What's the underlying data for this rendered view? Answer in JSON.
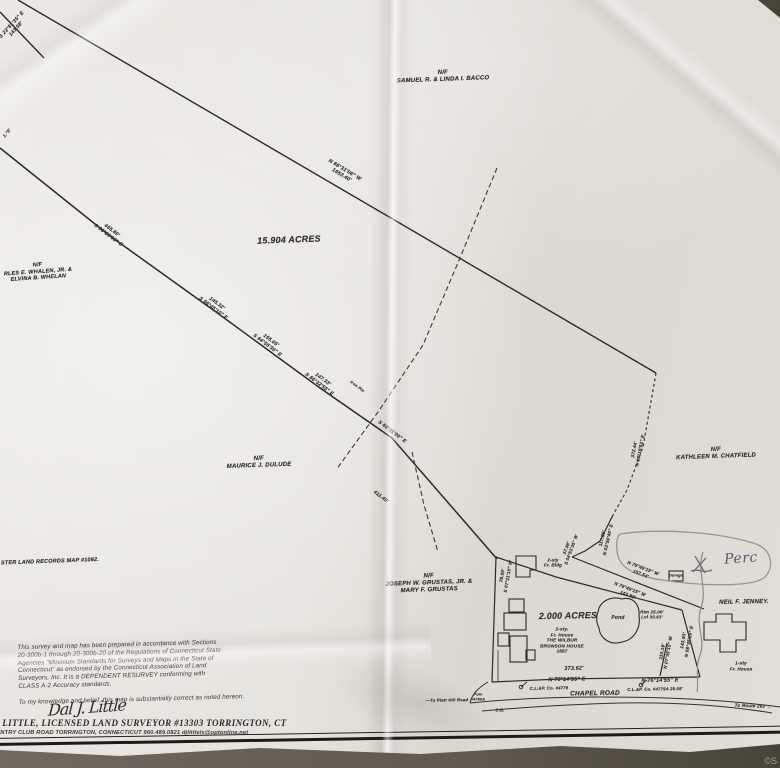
{
  "photo": {
    "watermark": "©S"
  },
  "map": {
    "annotations": [
      {
        "name": "nw-corner-bearing",
        "x": 14,
        "y": 27,
        "rot": -48,
        "size": 5,
        "lines": [
          "S 23°51'35\" E",
          "143.58'"
        ]
      },
      {
        "name": "west-edge-bearing-fragment",
        "x": 7,
        "y": 133,
        "rot": -50,
        "size": 4.5,
        "lines": [
          "1.°0'"
        ]
      },
      {
        "name": "owner-bacco",
        "x": 443,
        "y": 77,
        "rot": -2,
        "size": 6,
        "lines": [
          "N/F",
          "SAMUEL R. & LINDA I. BACCO"
        ]
      },
      {
        "name": "north-line-bearing",
        "x": 343,
        "y": 173,
        "rot": 31,
        "size": 5.2,
        "lines": [
          "N 66°31'06\" W",
          "1653.40'"
        ]
      },
      {
        "name": "owner-whalen",
        "x": 38,
        "y": 272,
        "rot": -4,
        "size": 5.5,
        "lines": [
          "N/F",
          "RLES E. WHALEN, JR. &",
          "ELVINA B. WHELAN"
        ]
      },
      {
        "name": "acreage-main",
        "x": 289,
        "y": 240,
        "rot": -2,
        "size": 9,
        "lines": [
          "15.904 ACRES"
        ]
      },
      {
        "name": "south-line-seg1",
        "x": 110,
        "y": 233,
        "rot": 37,
        "size": 5,
        "lines": [
          "465.80'",
          "S 66°20'05\" E"
        ]
      },
      {
        "name": "south-line-seg2",
        "x": 215,
        "y": 306,
        "rot": 37,
        "size": 5,
        "lines": [
          "145.32'",
          "S 66°45'10\" E"
        ]
      },
      {
        "name": "south-line-seg3",
        "x": 269,
        "y": 343,
        "rot": 37,
        "size": 5,
        "lines": [
          "155.05'",
          "S 64°55'30\" E"
        ]
      },
      {
        "name": "south-line-seg4",
        "x": 321,
        "y": 382,
        "rot": 37,
        "size": 5,
        "lines": [
          "147.33'",
          "S 66°32'55\" E"
        ]
      },
      {
        "name": "iron-pin-note",
        "x": 357,
        "y": 387,
        "rot": 37,
        "size": 4,
        "lines": [
          "Iron Pin"
        ]
      },
      {
        "name": "south-line-seg5",
        "x": 392,
        "y": 432,
        "rot": 37,
        "size": 5,
        "lines": [
          "S 66°11'00\" E"
        ]
      },
      {
        "name": "south-line-seg5-distance",
        "x": 381,
        "y": 497,
        "rot": 37,
        "size": 5,
        "lines": [
          "411.49'"
        ]
      },
      {
        "name": "owner-dulude",
        "x": 259,
        "y": 463,
        "rot": -2,
        "size": 6,
        "lines": [
          "N/F",
          "MAURICE J. DULUDE"
        ]
      },
      {
        "name": "owner-chatfield",
        "x": 716,
        "y": 454,
        "rot": -2,
        "size": 6,
        "lines": [
          "N/F",
          "KATHLEEN M. CHATFIELD"
        ]
      },
      {
        "name": "land-records-note",
        "x": 50,
        "y": 562,
        "rot": -2,
        "size": 5.5,
        "lines": [
          "STER LAND RECORDS MAP #1092."
        ]
      },
      {
        "name": "owner-grustas",
        "x": 429,
        "y": 584,
        "rot": -2,
        "size": 6,
        "lines": [
          "N/F",
          "JOSEPH W. GRUSTAS, JR. &",
          "MARY F. GRUSTAS"
        ]
      },
      {
        "name": "east-wall-bearing-372",
        "x": 637,
        "y": 450,
        "rot": -79,
        "size": 4.6,
        "lines": [
          "372.44'",
          "N 05°19'53\" E"
        ]
      },
      {
        "name": "east-wall-bearing-117",
        "x": 605,
        "y": 539,
        "rot": -77,
        "size": 4.6,
        "lines": [
          "117.85'",
          "N 03°50'40\" E"
        ]
      },
      {
        "name": "bearing-s0453",
        "x": 569,
        "y": 549,
        "rot": -70,
        "size": 4.4,
        "lines": [
          "37.98'",
          "S 04°53'35\" W"
        ]
      },
      {
        "name": "bearing-n7949-a",
        "x": 642,
        "y": 571,
        "rot": 21,
        "size": 4.6,
        "lines": [
          "N 79°49'15\" W",
          "157.54'"
        ]
      },
      {
        "name": "bearing-n7949-b",
        "x": 629,
        "y": 592,
        "rot": 21,
        "size": 4.6,
        "lines": [
          "N 79°49'15\" W",
          "143.88'"
        ]
      },
      {
        "name": "barn-label",
        "x": 553,
        "y": 563,
        "rot": 0,
        "size": 4.4,
        "lines": [
          "2-sty",
          "Fr. Bldg"
        ]
      },
      {
        "name": "bearing-s0711",
        "x": 505,
        "y": 576,
        "rot": -80,
        "size": 4.6,
        "lines": [
          "79.00'",
          "S 07°11'10\" W"
        ]
      },
      {
        "name": "acreage-parcel",
        "x": 568,
        "y": 616,
        "rot": -1,
        "size": 9,
        "lines": [
          "2.000 ACRES"
        ]
      },
      {
        "name": "bronson-house-label",
        "x": 562,
        "y": 640,
        "rot": 0,
        "size": 4.6,
        "lines": [
          "2-sty.",
          "Fr. House",
          "THE WILBUR",
          "BRONSON HOUSE",
          "1857"
        ]
      },
      {
        "name": "pond-label",
        "x": 618,
        "y": 618,
        "rot": 0,
        "size": 5,
        "lines": [
          "Pond"
        ]
      },
      {
        "name": "pond-elevations",
        "x": 652,
        "y": 615,
        "rot": 0,
        "size": 4.4,
        "lines": [
          "Rim 25.00'",
          "Lvl 30.63'"
        ]
      },
      {
        "name": "bearing-110",
        "x": 665,
        "y": 652,
        "rot": -80,
        "size": 4.6,
        "lines": [
          "110.19'",
          "N 07°35'15\" W"
        ]
      },
      {
        "name": "bearing-143",
        "x": 686,
        "y": 641,
        "rot": -80,
        "size": 4.6,
        "lines": [
          "143.93'",
          "N 08°35'15\" E"
        ]
      },
      {
        "name": "owner-jenney",
        "x": 744,
        "y": 603,
        "rot": -1,
        "size": 6,
        "lines": [
          "NEIL F. JENNEY."
        ]
      },
      {
        "name": "garage-label",
        "x": 676,
        "y": 576,
        "rot": 0,
        "size": 3.8,
        "lines": [
          "Garage"
        ]
      },
      {
        "name": "jenney-house-label",
        "x": 741,
        "y": 666,
        "rot": 0,
        "size": 4.6,
        "lines": [
          "1-sty",
          "Fr. House"
        ]
      },
      {
        "name": "road-distance-373",
        "x": 574,
        "y": 669,
        "rot": -1,
        "size": 5.4,
        "lines": [
          "373.62'"
        ]
      },
      {
        "name": "road-bearing-a",
        "x": 567,
        "y": 680,
        "rot": -1,
        "size": 5.4,
        "lines": [
          "N 76°14'55\" E"
        ]
      },
      {
        "name": "utility-pole-a-note",
        "x": 549,
        "y": 688,
        "rot": -1,
        "size": 4.2,
        "lines": [
          "C.L.&P. Co. #4779"
        ]
      },
      {
        "name": "road-bearing-b",
        "x": 660,
        "y": 681,
        "rot": -1,
        "size": 5.4,
        "lines": [
          "N 76°14'55\" E"
        ]
      },
      {
        "name": "utility-pole-b-note",
        "x": 655,
        "y": 689,
        "rot": -1,
        "size": 4.2,
        "lines": [
          "C.L.&P. Co. #4779A  25.08'"
        ]
      },
      {
        "name": "road-name",
        "x": 595,
        "y": 694,
        "rot": -1,
        "size": 6.5,
        "lines": [
          "CHAPEL  ROAD"
        ]
      },
      {
        "name": "route-note",
        "x": 753,
        "y": 706,
        "rot": 2,
        "size": 4.5,
        "lines": [
          "To Route 263 →"
        ]
      },
      {
        "name": "platt-hill-note",
        "x": 447,
        "y": 700,
        "rot": -1,
        "size": 4.2,
        "lines": [
          "—To Platt Hill Road"
        ]
      },
      {
        "name": "pole-4780-note",
        "x": 478,
        "y": 697,
        "rot": 0,
        "size": 3.8,
        "lines": [
          "Pole",
          "#4780A"
        ]
      },
      {
        "name": "catch-basin-note",
        "x": 500,
        "y": 710,
        "rot": 0,
        "size": 4.2,
        "lines": [
          "C.B."
        ]
      },
      {
        "name": "handwritten-perc",
        "x": 741,
        "y": 559,
        "rot": -4,
        "size": 14,
        "hand": true,
        "color": "#565b66",
        "lines": [
          "Perc"
        ]
      }
    ]
  },
  "certification": {
    "lines": [
      "This survey and map has been prepared in accordance with Sections",
      "20-300b-1 through 20-300b-20 of the Regulations of Connecticut State",
      "Agencies \"Minimum Standards for Surveys and Maps in the State of",
      "Connecticut\" as endorsed by the Connecticut Association of Land",
      "Surveyors, Inc. It is a DEPENDENT RESURVEY conforming with",
      "CLASS A-2 Accuracy standards.",
      "",
      "To my knowledge and belief, this map is substantially correct as noted hereon."
    ]
  },
  "signature": "Dal J. Little",
  "footer": {
    "line1": "J. LITTLE, LICENSED LAND SURVEYOR #13303    TORRINGTON, CT",
    "line2": "UNTRY CLUB ROAD TORRINGTON, CONNECTICUT 860.489.0821 djlittlels@optonline.net"
  }
}
